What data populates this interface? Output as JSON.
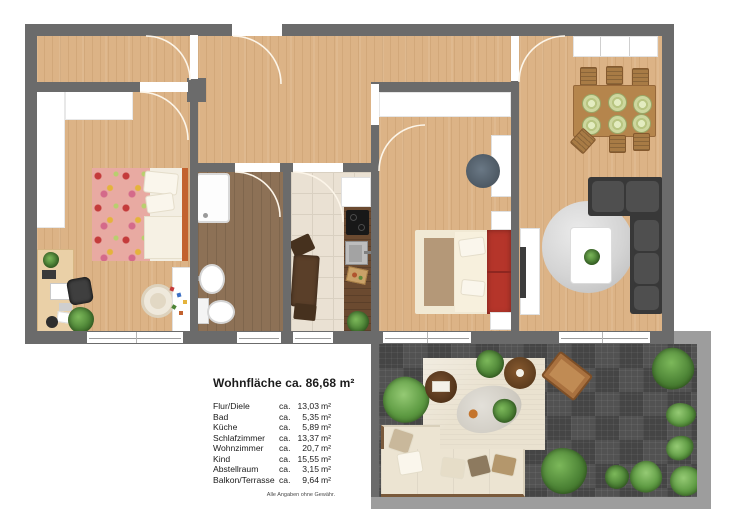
{
  "legend": {
    "title": "Wohnfläche ca. 86,68 m²",
    "rows": [
      {
        "name": "Flur/Diele",
        "ca": "ca.",
        "value": "13,03",
        "unit": "m²"
      },
      {
        "name": "Bad",
        "ca": "ca.",
        "value": "5,35",
        "unit": "m²"
      },
      {
        "name": "Küche",
        "ca": "ca.",
        "value": "5,89",
        "unit": "m²"
      },
      {
        "name": "Schlafzimmer",
        "ca": "ca.",
        "value": "13,37",
        "unit": "m²"
      },
      {
        "name": "Wohnzimmer",
        "ca": "ca.",
        "value": "20,7",
        "unit": "m²"
      },
      {
        "name": "Kind",
        "ca": "ca.",
        "value": "15,55",
        "unit": "m²"
      },
      {
        "name": "Abstellraum",
        "ca": "ca.",
        "value": "3,15",
        "unit": "m²"
      },
      {
        "name": "Balkon/Terrasse",
        "ca": "ca.",
        "value": "9,64",
        "unit": "m²"
      }
    ],
    "disclaimer": "Alle Angaben ohne Gewähr."
  },
  "colors": {
    "wall": "#6b6b6b",
    "balcony_wall": "#9d9d9d",
    "wood_floor": "#dcb386",
    "bath_floor": "#8d7156",
    "kitchen_floor": "#eae1d3",
    "balcony_deck": "#4b4b4b",
    "bed_accent_red": "#b5352a",
    "plant_green": "#4d8436"
  }
}
